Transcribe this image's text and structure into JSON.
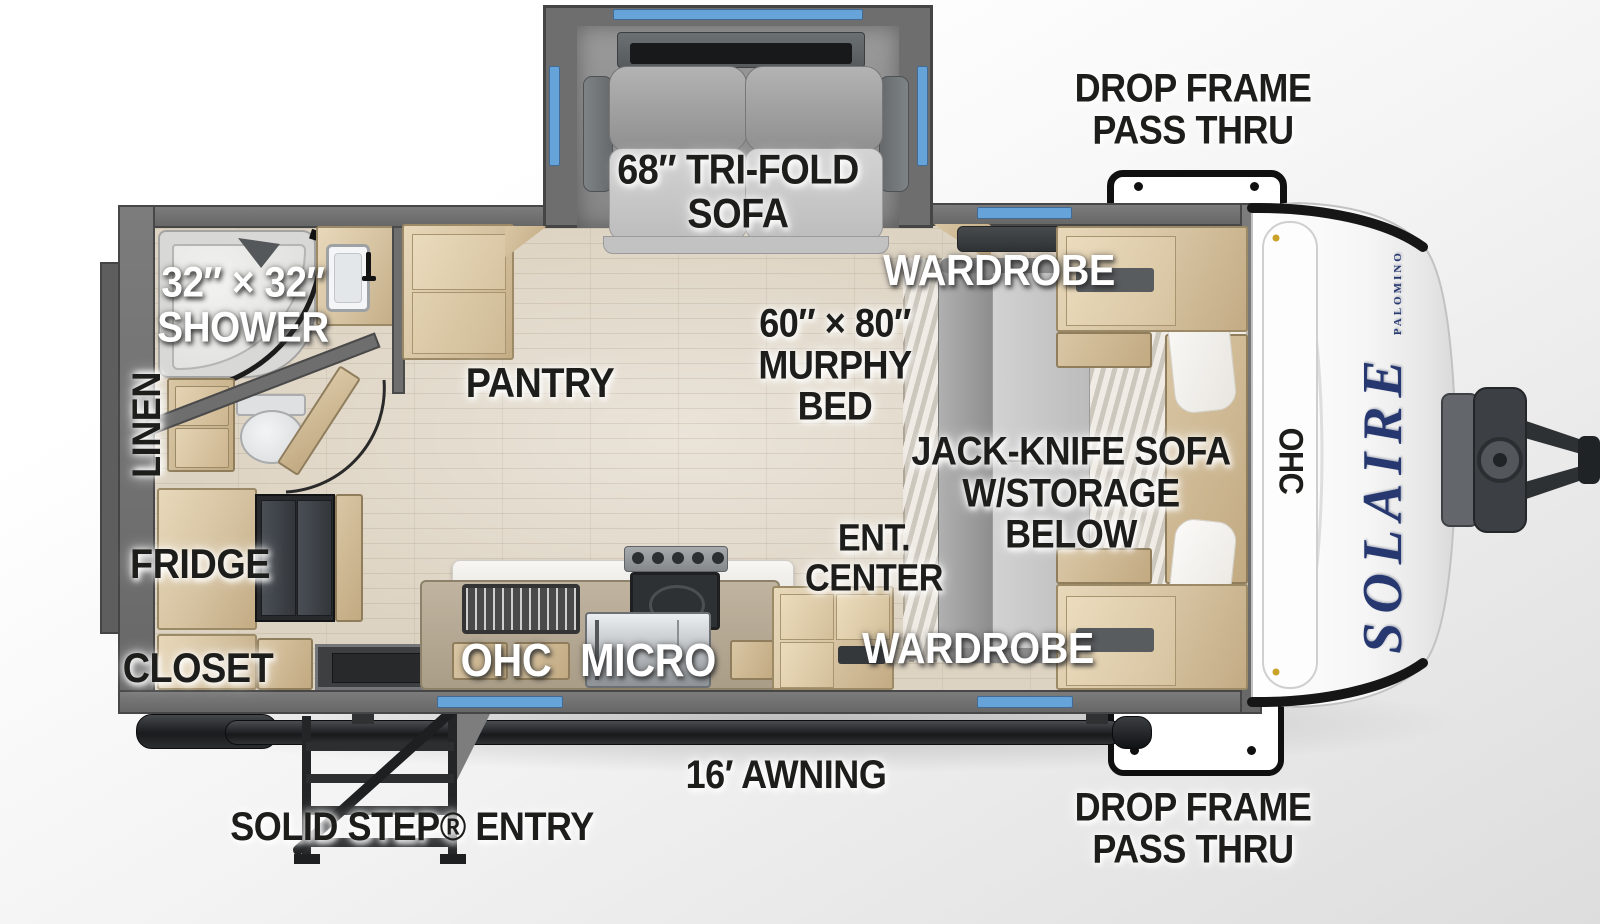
{
  "title": "Solaire travel trailer floor plan",
  "brand": {
    "name": "SOLAIRE",
    "maker": "PALOMINO"
  },
  "colors": {
    "window_accent": "#66a3d8",
    "wall_gray": "#6e6e6e",
    "floor_wood": "#ddd3c2",
    "cabinet_wood": "#d5c2a0",
    "logo_navy": "#26386f",
    "label_black": "#1d1d1b",
    "label_white": "#ffffff"
  },
  "labels": {
    "drop_frame_top": "DROP FRAME\nPASS THRU",
    "tri_fold_sofa": "68″ TRI-FOLD\nSOFA",
    "shower": "32″ × 32″\nSHOWER",
    "linen": "LINEN",
    "pantry": "PANTRY",
    "murphy_bed": "60″ × 80″\nMURPHY\nBED",
    "wardrobe_top": "WARDROBE",
    "jack_knife_sofa": "JACK-KNIFE SOFA\nW/STORAGE\nBELOW",
    "ent_center": "ENT.\nCENTER",
    "wardrobe_bottom": "WARDROBE",
    "fridge": "FRIDGE",
    "closet": "CLOSET",
    "ohc_kitchen": "OHC",
    "micro": "MICRO",
    "ohc_front": "OHC",
    "awning": "16′ AWNING",
    "solid_step_entry": "SOLID STEP® ENTRY",
    "drop_frame_bottom": "DROP FRAME\nPASS THRU"
  }
}
